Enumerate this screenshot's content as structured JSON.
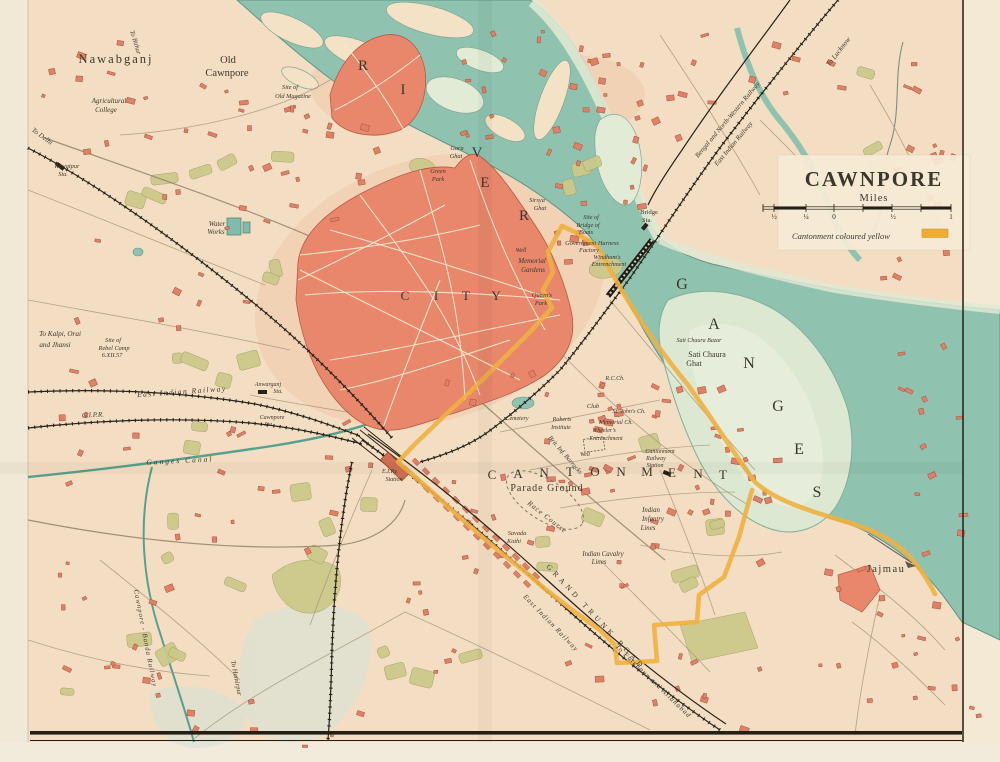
{
  "map_title": {
    "text": "CAWNPORE",
    "subtitle": "Miles"
  },
  "legend": {
    "text": "Cantonment coloured yellow",
    "swatch_color": "#efac33"
  },
  "scale_bar": {
    "ticks": [
      {
        "t": "½",
        "x": 774
      },
      {
        "t": "¼",
        "x": 806
      },
      {
        "t": "0",
        "x": 834
      },
      {
        "t": "½",
        "x": 893
      },
      {
        "t": "1",
        "x": 951
      }
    ]
  },
  "colors": {
    "paper": "#f5e1c6",
    "river": "#8fc3b0",
    "sandbank": "#dde8d2",
    "city_red": "#e8876c",
    "building_red": "#df8067",
    "grove_green": "#cbc98a",
    "cantonment_yellow": "#efb040",
    "railway_ink": "#262219",
    "label_ink": "#3a372c",
    "canal_teal": "#57a08e"
  },
  "labels": [
    {
      "n": "river-letter-r1",
      "t": "R",
      "x": 363,
      "y": 70,
      "s": 15,
      "c": "#474b42"
    },
    {
      "n": "river-letter-i",
      "t": "I",
      "x": 403,
      "y": 94,
      "s": 15,
      "c": "#474b42"
    },
    {
      "n": "river-letter-v",
      "t": "V",
      "x": 477,
      "y": 157,
      "s": 15,
      "c": "#474b42"
    },
    {
      "n": "river-letter-e",
      "t": "E",
      "x": 485,
      "y": 187,
      "s": 15,
      "c": "#474b42"
    },
    {
      "n": "river-letter-r2",
      "t": "R",
      "x": 524,
      "y": 220,
      "s": 15,
      "c": "#474b42"
    },
    {
      "n": "ganges-letter-g1",
      "t": "G",
      "x": 682,
      "y": 289,
      "s": 16,
      "c": "#474b42"
    },
    {
      "n": "ganges-letter-a",
      "t": "A",
      "x": 714,
      "y": 329,
      "s": 16,
      "c": "#474b42"
    },
    {
      "n": "ganges-letter-n",
      "t": "N",
      "x": 749,
      "y": 368,
      "s": 16,
      "c": "#474b42"
    },
    {
      "n": "ganges-letter-g2",
      "t": "G",
      "x": 778,
      "y": 411,
      "s": 16,
      "c": "#474b42"
    },
    {
      "n": "ganges-letter-e",
      "t": "E",
      "x": 799,
      "y": 454,
      "s": 16,
      "c": "#474b42"
    },
    {
      "n": "ganges-letter-s",
      "t": "S",
      "x": 817,
      "y": 497,
      "s": 16,
      "c": "#474b42"
    },
    {
      "n": "city-letter-c",
      "t": "C",
      "x": 405,
      "y": 300,
      "s": 13,
      "c": "#5c564a"
    },
    {
      "n": "city-letter-i",
      "t": "I",
      "x": 436,
      "y": 300,
      "s": 13,
      "c": "#5c564a"
    },
    {
      "n": "city-letter-t",
      "t": "T",
      "x": 466,
      "y": 300,
      "s": 13,
      "c": "#5c564a"
    },
    {
      "n": "city-letter-y",
      "t": "Y",
      "x": 496,
      "y": 300,
      "s": 13,
      "c": "#5c564a"
    },
    {
      "n": "cant-letter-1",
      "t": "C",
      "x": 492,
      "y": 479,
      "s": 13,
      "c": "#4f4a3e"
    },
    {
      "n": "cant-letter-2",
      "t": "A",
      "x": 518,
      "y": 478,
      "s": 13,
      "c": "#4f4a3e"
    },
    {
      "n": "cant-letter-3",
      "t": "N",
      "x": 544,
      "y": 477,
      "s": 13,
      "c": "#4f4a3e"
    },
    {
      "n": "cant-letter-4",
      "t": "T",
      "x": 570,
      "y": 476,
      "s": 13,
      "c": "#4f4a3e"
    },
    {
      "n": "cant-letter-5",
      "t": "O",
      "x": 595,
      "y": 476,
      "s": 13,
      "c": "#4f4a3e"
    },
    {
      "n": "cant-letter-6",
      "t": "N",
      "x": 621,
      "y": 476,
      "s": 13,
      "c": "#4f4a3e"
    },
    {
      "n": "cant-letter-7",
      "t": "M",
      "x": 647,
      "y": 476,
      "s": 13,
      "c": "#4f4a3e"
    },
    {
      "n": "cant-letter-8",
      "t": "E",
      "x": 672,
      "y": 477,
      "s": 13,
      "c": "#4f4a3e"
    },
    {
      "n": "cant-letter-9",
      "t": "N",
      "x": 698,
      "y": 478,
      "s": 13,
      "c": "#4f4a3e"
    },
    {
      "n": "cant-letter-10",
      "t": "T",
      "x": 723,
      "y": 479,
      "s": 13,
      "c": "#4f4a3e"
    },
    {
      "n": "grand-trunk-road",
      "t": "GRAND TRUNK ROAD",
      "x": 546,
      "y": 567,
      "s": 7.5,
      "r": 47,
      "sp": 4,
      "a": "s",
      "c": "#4a4438"
    },
    {
      "n": "nawabganj",
      "t": "Nawabganj",
      "x": 116,
      "y": 63,
      "s": 12.5,
      "sp": 2
    },
    {
      "n": "old-cawnpore-1",
      "t": "Old",
      "x": 228,
      "y": 63,
      "s": 10.5
    },
    {
      "n": "old-cawnpore-2",
      "t": "Cawnpore",
      "x": 227,
      "y": 76,
      "s": 10.5
    },
    {
      "n": "jajmau",
      "t": "Jajmau",
      "x": 886,
      "y": 572,
      "s": 10.5,
      "sp": 1.5
    },
    {
      "n": "parade-ground",
      "t": "Parade Ground",
      "x": 547,
      "y": 491,
      "s": 10,
      "sp": 1
    },
    {
      "n": "sati-chaura-ghat-1",
      "t": "Sati Chaura",
      "x": 707,
      "y": 357,
      "s": 8
    },
    {
      "n": "sati-chaura-ghat-2",
      "t": "Ghat",
      "x": 694,
      "y": 366,
      "s": 8
    },
    {
      "n": "bridge-sta-1",
      "t": "Bridge",
      "x": 649,
      "y": 214,
      "s": 6.5
    },
    {
      "n": "bridge-sta-2",
      "t": "Sta.",
      "x": 647,
      "y": 222,
      "s": 6.5
    },
    {
      "n": "agricultural-college-1",
      "t": "Agricultural",
      "x": 109,
      "y": 103,
      "s": 7,
      "i": 1
    },
    {
      "n": "agricultural-college-2",
      "t": "College",
      "x": 106,
      "y": 112,
      "s": 7,
      "i": 1
    },
    {
      "n": "to-delhi",
      "t": "To Delhi",
      "x": 41,
      "y": 138,
      "s": 7,
      "r": 36,
      "i": 1
    },
    {
      "n": "rawatpur-sta-1",
      "t": "Rawatpur",
      "x": 67,
      "y": 168,
      "s": 6.3,
      "i": 1
    },
    {
      "n": "rawatpur-sta-2",
      "t": "Sta.",
      "x": 63,
      "y": 176,
      "s": 6.3,
      "i": 1
    },
    {
      "n": "site-of-magazine-1",
      "t": "Site of",
      "x": 290,
      "y": 89,
      "s": 6.3,
      "i": 1
    },
    {
      "n": "site-of-magazine-2",
      "t": "Old Magazine",
      "x": 293,
      "y": 98,
      "s": 6.3,
      "i": 1
    },
    {
      "n": "water-works-1",
      "t": "Water",
      "x": 217,
      "y": 226,
      "s": 7,
      "i": 1
    },
    {
      "n": "water-works-2",
      "t": "Works",
      "x": 216,
      "y": 234,
      "s": 7,
      "i": 1
    },
    {
      "n": "to-kalpi-1",
      "t": "To Kalpi, Orai",
      "x": 60,
      "y": 336,
      "s": 7.2,
      "i": 1
    },
    {
      "n": "to-kalpi-2",
      "t": "and Jhansi",
      "x": 55,
      "y": 347,
      "s": 7.2,
      "i": 1
    },
    {
      "n": "rebel-camp-1",
      "t": "Site of",
      "x": 113,
      "y": 342,
      "s": 6.3,
      "i": 1
    },
    {
      "n": "rebel-camp-2",
      "t": "Rebel Camp",
      "x": 114,
      "y": 350,
      "s": 6.3,
      "i": 1
    },
    {
      "n": "rebel-camp-3",
      "t": "6.XII.57",
      "x": 112,
      "y": 357,
      "s": 6.3,
      "i": 1
    },
    {
      "n": "east-indian-railway-w",
      "t": "East Indian Railway",
      "x": 182,
      "y": 394,
      "s": 7.5,
      "r": -4,
      "sp": 1.5,
      "i": 1
    },
    {
      "n": "gipr",
      "t": "G.I.P.R.",
      "x": 93,
      "y": 417,
      "s": 7,
      "r": -3,
      "i": 1
    },
    {
      "n": "ganges-canal",
      "t": "Ganges Canal",
      "x": 180,
      "y": 463,
      "s": 7.5,
      "r": -3,
      "sp": 2,
      "i": 1
    },
    {
      "n": "anwarganj-sta-1",
      "t": "Anwarganj",
      "x": 268,
      "y": 386,
      "s": 6,
      "i": 1
    },
    {
      "n": "anwarganj-sta-2",
      "t": "Sta.",
      "x": 278,
      "y": 393,
      "s": 6,
      "i": 1
    },
    {
      "n": "cawnpore-sta-1",
      "t": "Cawnpore",
      "x": 272,
      "y": 419,
      "s": 6,
      "i": 1
    },
    {
      "n": "cawnpore-sta-2",
      "t": "Sta.",
      "x": 269,
      "y": 426,
      "s": 6,
      "i": 1
    },
    {
      "n": "eir-station-1",
      "t": "E.I.Ry.",
      "x": 390,
      "y": 473,
      "s": 6,
      "i": 1
    },
    {
      "n": "eir-station-2",
      "t": "Station",
      "x": 394,
      "y": 481,
      "s": 6,
      "i": 1
    },
    {
      "n": "gora-ghat-1",
      "t": "Gora",
      "x": 457,
      "y": 150,
      "s": 6.3,
      "i": 1
    },
    {
      "n": "gora-ghat-2",
      "t": "Ghat",
      "x": 456,
      "y": 158,
      "s": 6.3,
      "i": 1
    },
    {
      "n": "green-park-1",
      "t": "Green",
      "x": 438,
      "y": 173,
      "s": 6.3,
      "i": 1
    },
    {
      "n": "green-park-2",
      "t": "Park",
      "x": 438,
      "y": 181,
      "s": 6.3,
      "i": 1
    },
    {
      "n": "sirsya-ghat-1",
      "t": "Sirsya",
      "x": 537,
      "y": 202,
      "s": 6.3,
      "i": 1
    },
    {
      "n": "sirsya-ghat-2",
      "t": "Ghat",
      "x": 540,
      "y": 210,
      "s": 6.3,
      "i": 1
    },
    {
      "n": "bridge-of-boats-1",
      "t": "Site of",
      "x": 591,
      "y": 219,
      "s": 6.2,
      "i": 1
    },
    {
      "n": "bridge-of-boats-2",
      "t": "Bridge of",
      "x": 588,
      "y": 227,
      "s": 6.2,
      "i": 1
    },
    {
      "n": "bridge-of-boats-3",
      "t": "Boats",
      "x": 586,
      "y": 234,
      "s": 6.2,
      "i": 1
    },
    {
      "n": "harness-factory-1",
      "t": "Government Harness",
      "x": 592,
      "y": 245,
      "s": 6.3,
      "i": 1
    },
    {
      "n": "harness-factory-2",
      "t": "Factory",
      "x": 589,
      "y": 252,
      "s": 6.3,
      "i": 1
    },
    {
      "n": "windhams-1",
      "t": "Windham's",
      "x": 607,
      "y": 259,
      "s": 6.2,
      "i": 1
    },
    {
      "n": "windhams-2",
      "t": "Entrenchment",
      "x": 609,
      "y": 266,
      "s": 6.2,
      "i": 1
    },
    {
      "n": "memorial-well",
      "t": "Well",
      "x": 521,
      "y": 252,
      "s": 6.2,
      "i": 1
    },
    {
      "n": "memorial-gardens-1",
      "t": "Memorial",
      "x": 532,
      "y": 263,
      "s": 7,
      "i": 1
    },
    {
      "n": "memorial-gardens-2",
      "t": "Gardens",
      "x": 533,
      "y": 272,
      "s": 7,
      "i": 1
    },
    {
      "n": "queens-park-1",
      "t": "Queen's",
      "x": 542,
      "y": 297,
      "s": 6.3,
      "i": 1
    },
    {
      "n": "queens-park-2",
      "t": "Park",
      "x": 541,
      "y": 305,
      "s": 6.3,
      "i": 1
    },
    {
      "n": "to-lucknow",
      "t": "To Lucknow",
      "x": 840,
      "y": 53,
      "s": 7.2,
      "r": -52,
      "i": 1
    },
    {
      "n": "bnw-railway",
      "t": "Bengal and North-Western Railway",
      "x": 729,
      "y": 121,
      "s": 6.8,
      "r": -50,
      "i": 1
    },
    {
      "n": "east-indian-railway-ne",
      "t": "East Indian Railway",
      "x": 735,
      "y": 145,
      "s": 6.8,
      "r": -50,
      "i": 1
    },
    {
      "n": "rc-church",
      "t": "R.C.Ch.",
      "x": 615,
      "y": 380,
      "s": 6,
      "i": 1
    },
    {
      "n": "club",
      "t": "Club",
      "x": 593,
      "y": 408,
      "s": 6.3,
      "i": 1
    },
    {
      "n": "st-johns-church",
      "t": "St. John's Ch.",
      "x": 629,
      "y": 413,
      "s": 6,
      "i": 1
    },
    {
      "n": "memorial-church",
      "t": "Memorial Ch.",
      "x": 616,
      "y": 424,
      "s": 6,
      "i": 1
    },
    {
      "n": "wheelers-1",
      "t": "Wheeler's",
      "x": 604,
      "y": 432,
      "s": 6,
      "i": 1
    },
    {
      "n": "wheelers-2",
      "t": "Entrenchment",
      "x": 606,
      "y": 440,
      "s": 6,
      "i": 1
    },
    {
      "n": "roberts-institute-1",
      "t": "Roberts",
      "x": 562,
      "y": 421,
      "s": 6,
      "i": 1
    },
    {
      "n": "roberts-institute-2",
      "t": "Institute",
      "x": 561,
      "y": 429,
      "s": 6,
      "i": 1
    },
    {
      "n": "brit-inf-barracks",
      "t": "Brit. Inf. Barracks",
      "x": 548,
      "y": 438,
      "s": 6.6,
      "r": 49,
      "a": "s",
      "i": 1
    },
    {
      "n": "well-cantonment",
      "t": "Well",
      "x": 585,
      "y": 456,
      "s": 5.8,
      "i": 1
    },
    {
      "n": "cemetery",
      "t": "Cemetery",
      "x": 517,
      "y": 420,
      "s": 6,
      "i": 1
    },
    {
      "n": "cantonment-rly-sta-1",
      "t": "Cantonment",
      "x": 660,
      "y": 453,
      "s": 6,
      "i": 1
    },
    {
      "n": "cantonment-rly-sta-2",
      "t": "Railway",
      "x": 656,
      "y": 460,
      "s": 6,
      "i": 1
    },
    {
      "n": "cantonment-rly-sta-3",
      "t": "Station",
      "x": 655,
      "y": 467,
      "s": 6,
      "i": 1
    },
    {
      "n": "race-course",
      "t": "Race Course",
      "x": 527,
      "y": 504,
      "s": 7.2,
      "r": 38,
      "a": "s",
      "sp": 1,
      "i": 1
    },
    {
      "n": "savada-kothi-1",
      "t": "Savada",
      "x": 517,
      "y": 535,
      "s": 6.3,
      "i": 1
    },
    {
      "n": "savada-kothi-2",
      "t": "Kothi",
      "x": 514,
      "y": 543,
      "s": 6.3,
      "i": 1
    },
    {
      "n": "indian-infantry-1",
      "t": "Indian",
      "x": 651,
      "y": 512,
      "s": 6.8,
      "i": 1
    },
    {
      "n": "indian-infantry-2",
      "t": "Infantry",
      "x": 653,
      "y": 521,
      "s": 6.8,
      "i": 1
    },
    {
      "n": "indian-infantry-3",
      "t": "Lines",
      "x": 648,
      "y": 530,
      "s": 6.8,
      "i": 1
    },
    {
      "n": "indian-cavalry-1",
      "t": "Indian Cavalry",
      "x": 603,
      "y": 556,
      "s": 6.8,
      "i": 1
    },
    {
      "n": "indian-cavalry-2",
      "t": "Lines",
      "x": 599,
      "y": 564,
      "s": 6.8,
      "i": 1
    },
    {
      "n": "sati-chaura-bazar",
      "t": "Sati Chaura Bazar",
      "x": 699,
      "y": 342,
      "s": 6,
      "i": 1
    },
    {
      "n": "east-indian-railway-gt",
      "t": "East Indian Railway",
      "x": 523,
      "y": 597,
      "s": 7,
      "r": 46,
      "a": "s",
      "sp": 1,
      "i": 1
    },
    {
      "n": "to-fatehpur",
      "t": "To Fatehpur and Allahabad",
      "x": 615,
      "y": 647,
      "s": 7,
      "r": 44,
      "a": "s",
      "sp": 1,
      "i": 1
    },
    {
      "n": "cawnpore-banda-railway",
      "t": "Cawnpore - Banda Railway",
      "x": 134,
      "y": 590,
      "s": 6.8,
      "r": 79,
      "a": "s",
      "sp": 1,
      "i": 1
    },
    {
      "n": "to-hamirpur",
      "t": "To Hamirpur",
      "x": 231,
      "y": 661,
      "s": 6.8,
      "r": 79,
      "a": "s",
      "i": 1
    },
    {
      "n": "to-bithur",
      "t": "To Bithur",
      "x": 130,
      "y": 31,
      "s": 6.6,
      "r": 73,
      "a": "s",
      "i": 1
    }
  ]
}
